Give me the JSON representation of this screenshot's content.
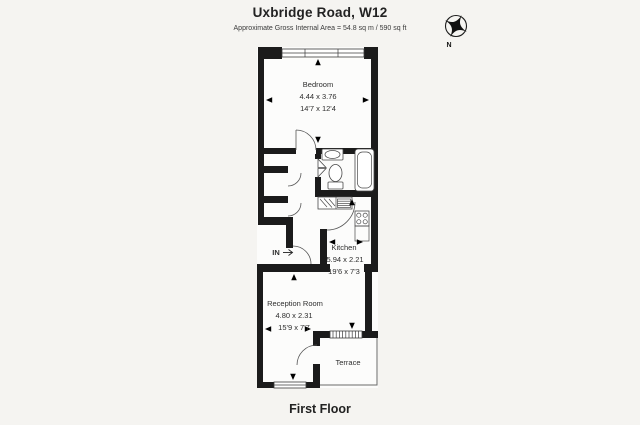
{
  "header": {
    "title": "Uxbridge Road, W12",
    "subtitle": "Approximate Gross Internal Area = 54.8 sq m / 590 sq ft"
  },
  "footer": {
    "floor_label": "First Floor"
  },
  "compass": {
    "north_label": "N"
  },
  "entry": {
    "label": "IN"
  },
  "rooms": {
    "bedroom": {
      "name": "Bedroom",
      "metric": "4.44 x 3.76",
      "imperial": "14'7 x 12'4"
    },
    "kitchen": {
      "name": "Kitchen",
      "metric": "5.94 x 2.21",
      "imperial": "19'6 x 7'3"
    },
    "reception": {
      "name": "Reception Room",
      "metric": "4.80 x 2.31",
      "imperial": "15'9 x 7'7"
    },
    "terrace": {
      "name": "Terrace"
    }
  },
  "colors": {
    "background": "#f5f4f1",
    "wall": "#1b1b1b",
    "text": "#2e2e2e"
  }
}
